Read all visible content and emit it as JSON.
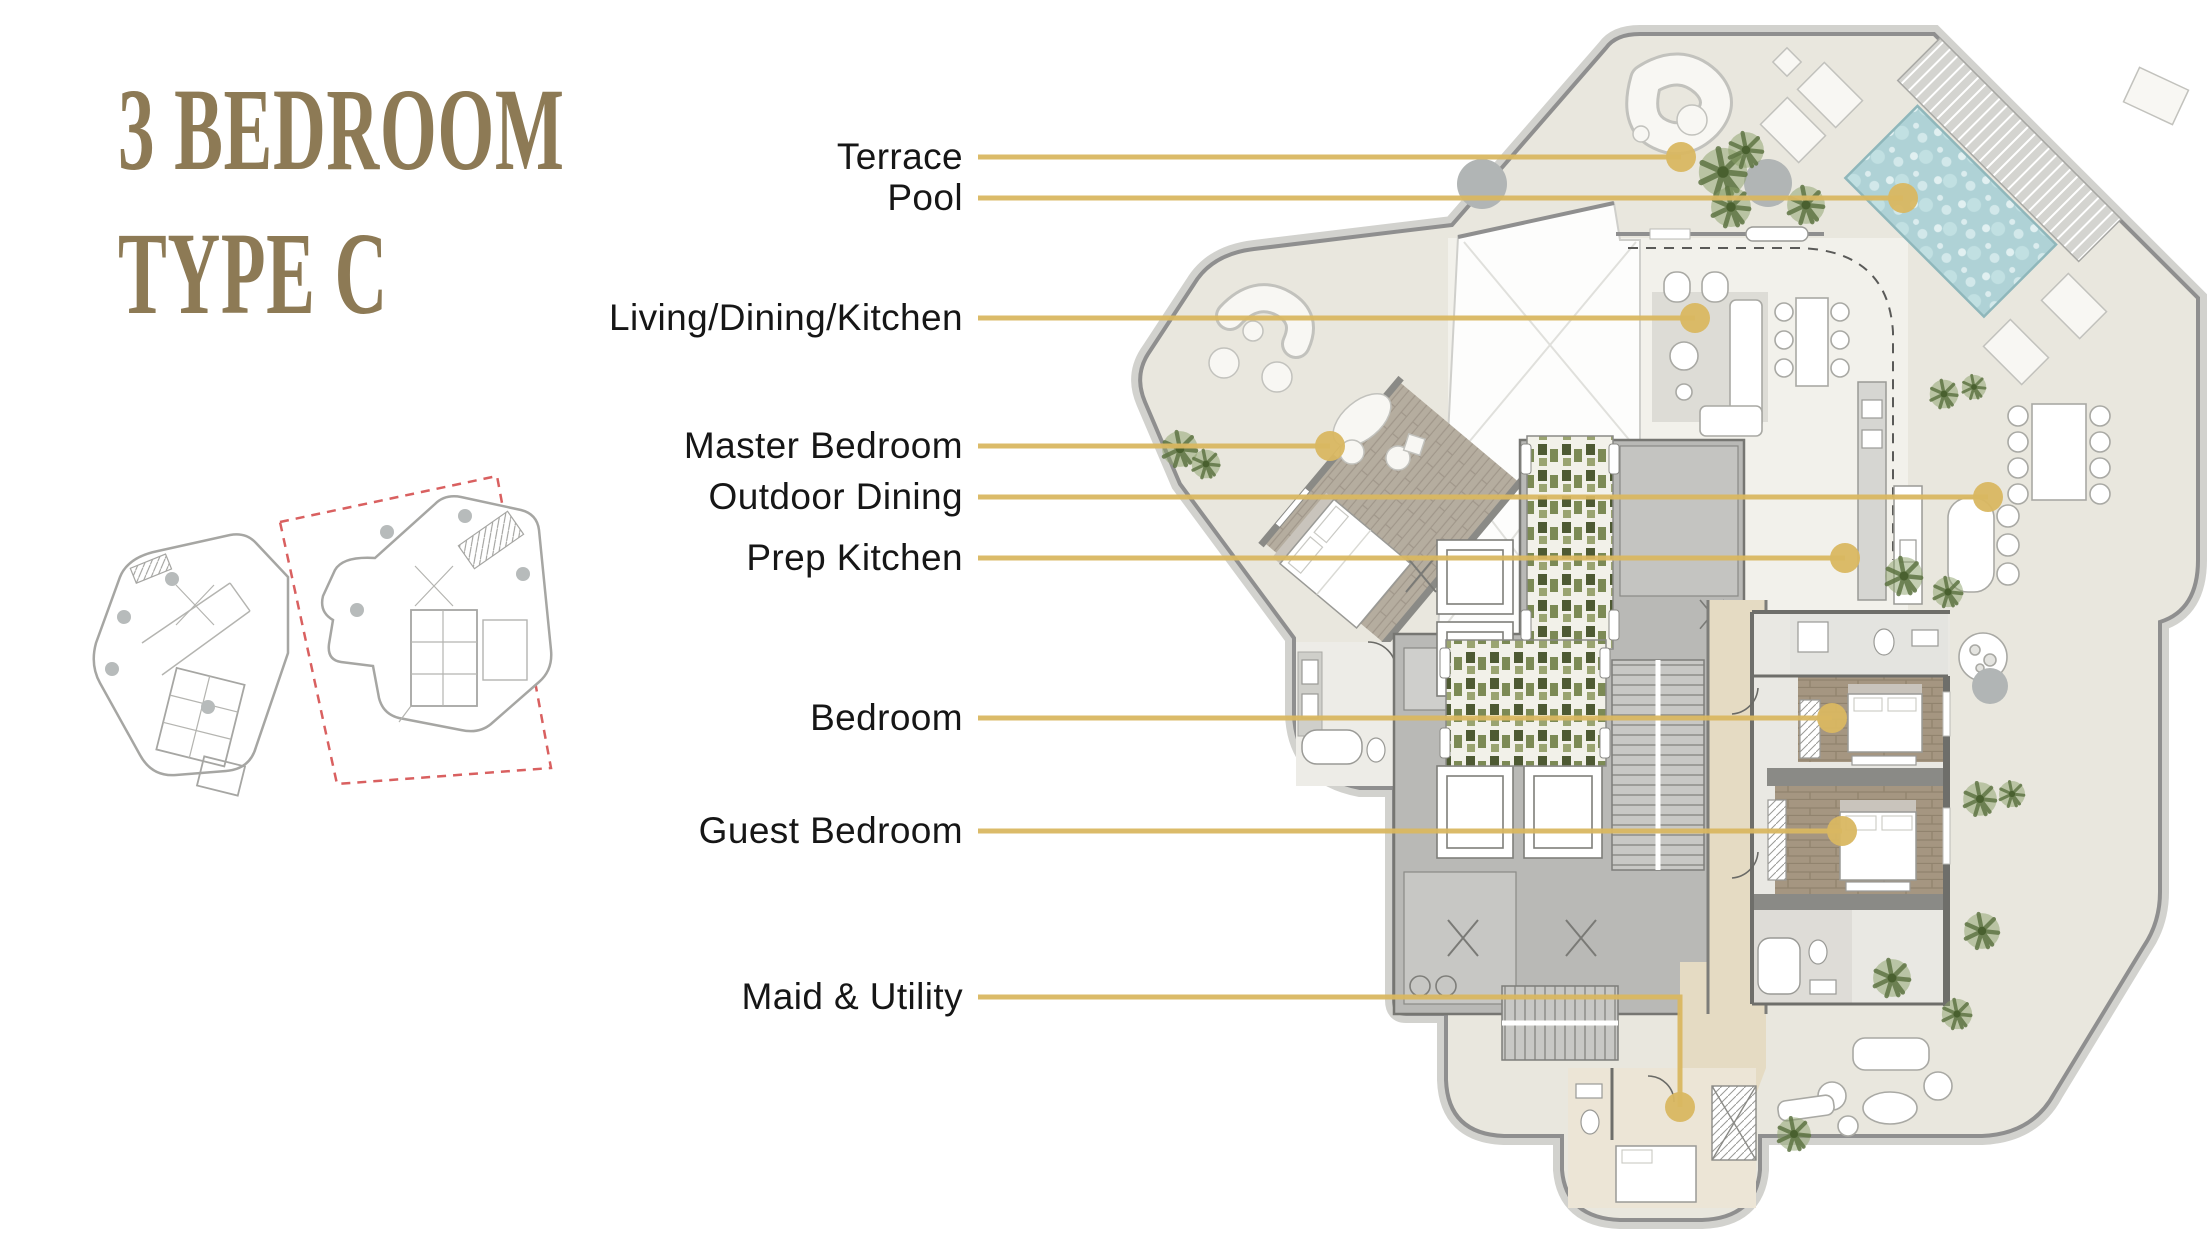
{
  "title": {
    "line1": "3 BEDROOM",
    "line2": "TYPE C",
    "color": "#8D7A55"
  },
  "colors": {
    "accent_gold": "#D8B55F",
    "leader": "#D9B761",
    "dot": "#D9B761",
    "title_bronze": "#8D7A55",
    "label_text": "#161616",
    "red_dash": "#D96060",
    "pool_water": "#AFD2D6",
    "terrace_floor": "#E9E7DE",
    "interior_floor": "#F2F1EB",
    "core_gray": "#B9B9B6",
    "corridor_tan": "#E5DBC3",
    "wood_floor": "#A59681",
    "wall_gray": "#8F8F8F",
    "tree_green": "#5F7544",
    "tree_gray": "#B1B5B5"
  },
  "callouts": [
    {
      "id": "terrace",
      "label": "Terrace",
      "anchor": {
        "x": 963,
        "y": 157
      },
      "line": [
        [
          978,
          157
        ],
        [
          1681,
          157
        ]
      ],
      "dot": [
        1681,
        157
      ]
    },
    {
      "id": "pool",
      "label": "Pool",
      "anchor": {
        "x": 963,
        "y": 198
      },
      "line": [
        [
          978,
          198
        ],
        [
          1903,
          198
        ]
      ],
      "dot": [
        1903,
        198
      ]
    },
    {
      "id": "living-dining-kitchen",
      "label": "Living/Dining/Kitchen",
      "anchor": {
        "x": 963,
        "y": 318
      },
      "line": [
        [
          978,
          318
        ],
        [
          1695,
          318
        ]
      ],
      "dot": [
        1695,
        318
      ]
    },
    {
      "id": "master-bedroom",
      "label": "Master Bedroom",
      "anchor": {
        "x": 963,
        "y": 446
      },
      "line": [
        [
          978,
          446
        ],
        [
          1330,
          446
        ]
      ],
      "dot": [
        1330,
        446
      ]
    },
    {
      "id": "outdoor-dining",
      "label": "Outdoor Dining",
      "anchor": {
        "x": 963,
        "y": 497
      },
      "line": [
        [
          978,
          497
        ],
        [
          1988,
          497
        ]
      ],
      "dot": [
        1988,
        497
      ]
    },
    {
      "id": "prep-kitchen",
      "label": "Prep Kitchen",
      "anchor": {
        "x": 963,
        "y": 558
      },
      "line": [
        [
          978,
          558
        ],
        [
          1845,
          558
        ]
      ],
      "dot": [
        1845,
        558
      ]
    },
    {
      "id": "bedroom",
      "label": "Bedroom",
      "anchor": {
        "x": 963,
        "y": 718
      },
      "line": [
        [
          978,
          718
        ],
        [
          1832,
          718
        ]
      ],
      "dot": [
        1832,
        718
      ]
    },
    {
      "id": "guest-bedroom",
      "label": "Guest Bedroom",
      "anchor": {
        "x": 963,
        "y": 831
      },
      "line": [
        [
          978,
          831
        ],
        [
          1842,
          831
        ]
      ],
      "dot": [
        1842,
        831
      ]
    },
    {
      "id": "maid-utility",
      "label": "Maid & Utility",
      "anchor": {
        "x": 963,
        "y": 997
      },
      "line": [
        [
          978,
          997
        ],
        [
          1680,
          997
        ],
        [
          1680,
          1107
        ]
      ],
      "dot": [
        1680,
        1107
      ]
    }
  ],
  "key_plans": {
    "items": [
      {
        "name": "key-plan-a",
        "highlighted": false
      },
      {
        "name": "key-plan-b",
        "highlighted": true
      }
    ]
  }
}
